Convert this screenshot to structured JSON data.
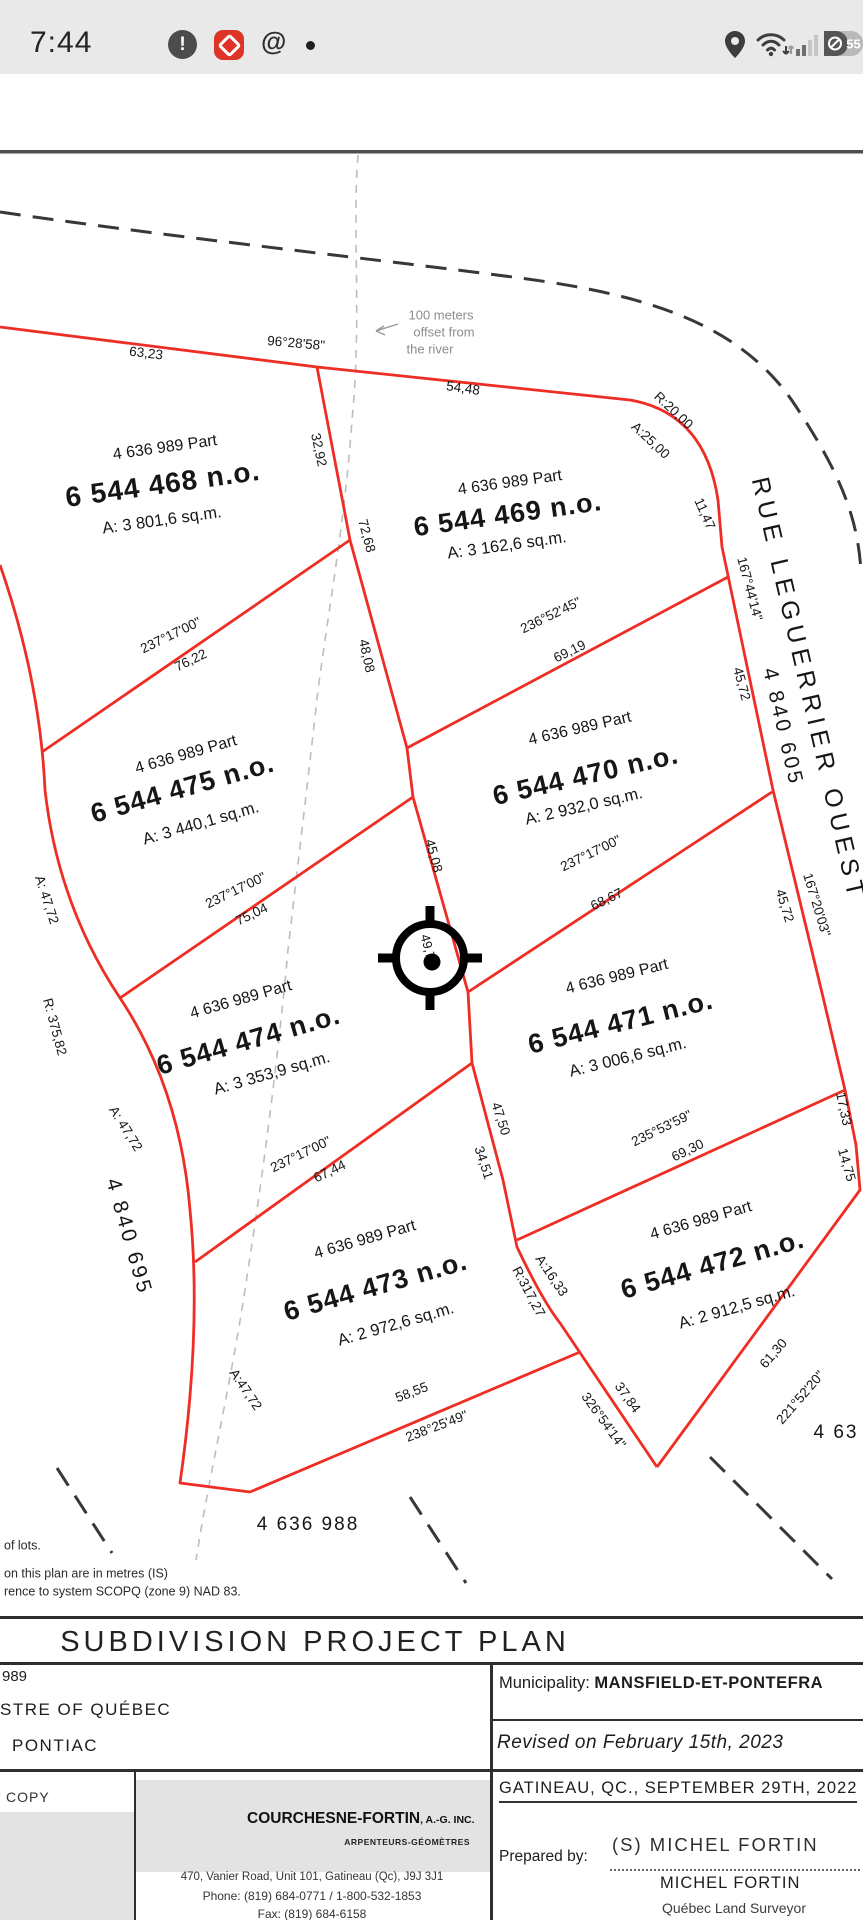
{
  "status_bar": {
    "time": "7:44",
    "battery_percent": "55",
    "icons": {
      "left": [
        "notification-exclamation-icon",
        "red-app-icon",
        "threads-icon",
        "recording-dot"
      ],
      "right": [
        "location-icon",
        "wifi-icon",
        "cell-signal-icon",
        "battery-icon"
      ]
    }
  },
  "plan": {
    "colors": {
      "lot_line": "#ee2e24",
      "boundary_dash": "#383838",
      "river_dash": "#bdbdbd",
      "text": "#161616",
      "muted": "#8d8d8d"
    },
    "labels": [
      {
        "t": "63,23",
        "x": 146,
        "y": 354,
        "r": 7,
        "s": 13.5,
        "n": "dim-label"
      },
      {
        "t": "96°28'58\"",
        "x": 296,
        "y": 344,
        "r": 5,
        "s": 13.5,
        "n": "dim-label"
      },
      {
        "t": "54,48",
        "x": 463,
        "y": 389,
        "r": 8,
        "s": 13.5,
        "n": "dim-label"
      },
      {
        "t": "R:20,00",
        "x": 673,
        "y": 411,
        "r": 43,
        "s": 13.5,
        "n": "dim-label"
      },
      {
        "t": "A:25,00",
        "x": 650,
        "y": 441,
        "r": 43,
        "s": 13.5,
        "n": "dim-label"
      },
      {
        "t": "11,47",
        "x": 704,
        "y": 514,
        "r": 66,
        "s": 13.5,
        "n": "dim-label"
      },
      {
        "t": "167°44'14\"",
        "x": 749,
        "y": 589,
        "r": 75,
        "s": 13.5,
        "n": "dim-label"
      },
      {
        "t": "45,72",
        "x": 741,
        "y": 684,
        "r": 75,
        "s": 13.5,
        "n": "dim-label"
      },
      {
        "t": "32,92",
        "x": 318,
        "y": 450,
        "r": 78,
        "s": 13.5,
        "n": "dim-label"
      },
      {
        "t": "72,68",
        "x": 366,
        "y": 536,
        "r": 75,
        "s": 13.5,
        "n": "dim-label"
      },
      {
        "t": "48,08",
        "x": 366,
        "y": 656,
        "r": 78,
        "s": 13.5,
        "n": "dim-label"
      },
      {
        "t": "45,08",
        "x": 433,
        "y": 856,
        "r": 75,
        "s": 13.5,
        "n": "dim-label"
      },
      {
        "t": "49,7",
        "x": 427,
        "y": 947,
        "r": 75,
        "s": 13,
        "n": "dim-label"
      },
      {
        "t": "47,50",
        "x": 500,
        "y": 1119,
        "r": 72,
        "s": 13.5,
        "n": "dim-label"
      },
      {
        "t": "34,51",
        "x": 483,
        "y": 1163,
        "r": 72,
        "s": 13.5,
        "n": "dim-label"
      },
      {
        "t": "A:16,33",
        "x": 551,
        "y": 1276,
        "r": 56,
        "s": 13.5,
        "n": "dim-label"
      },
      {
        "t": "R:317,27",
        "x": 528,
        "y": 1292,
        "r": 62,
        "s": 13.5,
        "n": "dim-label"
      },
      {
        "t": "37,84",
        "x": 627,
        "y": 1398,
        "r": 54,
        "s": 13.5,
        "n": "dim-label"
      },
      {
        "t": "326°54'14\"",
        "x": 603,
        "y": 1421,
        "r": 54,
        "s": 13.5,
        "n": "dim-label"
      },
      {
        "t": "61,30",
        "x": 774,
        "y": 1354,
        "r": -49,
        "s": 13.5,
        "n": "dim-label"
      },
      {
        "t": "221°52'20\"",
        "x": 801,
        "y": 1398,
        "r": -49,
        "s": 13.5,
        "n": "dim-label"
      },
      {
        "t": "58,55",
        "x": 412,
        "y": 1393,
        "r": -21,
        "s": 13.5,
        "n": "dim-label"
      },
      {
        "t": "238°25'49\"",
        "x": 437,
        "y": 1427,
        "r": -21,
        "s": 13.5,
        "n": "dim-label"
      },
      {
        "t": "235°53'59\"",
        "x": 662,
        "y": 1129,
        "r": -26,
        "s": 13.5,
        "n": "dim-label"
      },
      {
        "t": "69,30",
        "x": 688,
        "y": 1151,
        "r": -26,
        "s": 13.5,
        "n": "dim-label"
      },
      {
        "t": "237°17'00\"",
        "x": 171,
        "y": 636,
        "r": -26,
        "s": 13.5,
        "n": "dim-label"
      },
      {
        "t": "76,22",
        "x": 191,
        "y": 661,
        "r": -26,
        "s": 13.5,
        "n": "dim-label"
      },
      {
        "t": "236°52'45\"",
        "x": 551,
        "y": 616,
        "r": -26,
        "s": 13.5,
        "n": "dim-label"
      },
      {
        "t": "69,19",
        "x": 570,
        "y": 652,
        "r": -26,
        "s": 13.5,
        "n": "dim-label"
      },
      {
        "t": "237°17'00\"",
        "x": 236,
        "y": 891,
        "r": -26,
        "s": 13.5,
        "n": "dim-label"
      },
      {
        "t": "75,04",
        "x": 252,
        "y": 915,
        "r": -26,
        "s": 13.5,
        "n": "dim-label"
      },
      {
        "t": "237°17'00\"",
        "x": 591,
        "y": 854,
        "r": -26,
        "s": 13.5,
        "n": "dim-label"
      },
      {
        "t": "68,67",
        "x": 607,
        "y": 900,
        "r": -26,
        "s": 13.5,
        "n": "dim-label"
      },
      {
        "t": "237°17'00\"",
        "x": 301,
        "y": 1155,
        "r": -26,
        "s": 13.5,
        "n": "dim-label"
      },
      {
        "t": "67,44",
        "x": 330,
        "y": 1172,
        "r": -26,
        "s": 13.5,
        "n": "dim-label"
      },
      {
        "t": "A: 47,72",
        "x": 46,
        "y": 900,
        "r": 72,
        "s": 13.5,
        "n": "dim-label"
      },
      {
        "t": "R: 375,82",
        "x": 54,
        "y": 1027,
        "r": 75,
        "s": 13.5,
        "n": "dim-label"
      },
      {
        "t": "A: 47,72",
        "x": 125,
        "y": 1129,
        "r": 58,
        "s": 13.5,
        "n": "dim-label"
      },
      {
        "t": "A:47,72",
        "x": 245,
        "y": 1390,
        "r": 56,
        "s": 13.5,
        "n": "dim-label"
      },
      {
        "t": "17,33",
        "x": 843,
        "y": 1109,
        "r": 78,
        "s": 13.5,
        "n": "dim-label"
      },
      {
        "t": "14,75",
        "x": 846,
        "y": 1165,
        "r": 74,
        "s": 13.5,
        "n": "dim-label"
      },
      {
        "t": "167°20'03\"",
        "x": 816,
        "y": 905,
        "r": 73,
        "s": 13.5,
        "n": "dim-label"
      },
      {
        "t": "45,72",
        "x": 784,
        "y": 906,
        "r": 73,
        "s": 13.5,
        "n": "dim-label"
      },
      {
        "t": "4 636 989 Part",
        "x": 165,
        "y": 448,
        "r": -8,
        "s": 16,
        "n": "lot-part"
      },
      {
        "t": "6 544 468 n.o.",
        "x": 163,
        "y": 486,
        "r": -8,
        "s": 28,
        "b": 1,
        "ls": 1,
        "n": "lot-number"
      },
      {
        "t": "A: 3 801,6 sq.m.",
        "x": 162,
        "y": 521,
        "r": -8,
        "s": 16.5,
        "n": "lot-area"
      },
      {
        "t": "4 636 989 Part",
        "x": 510,
        "y": 483,
        "r": -8,
        "s": 16,
        "n": "lot-part"
      },
      {
        "t": "6 544 469 n.o.",
        "x": 508,
        "y": 516,
        "r": -8,
        "s": 27,
        "b": 1,
        "ls": 1,
        "n": "lot-number"
      },
      {
        "t": "A: 3 162,6 sq.m.",
        "x": 507,
        "y": 546,
        "r": -8,
        "s": 16.5,
        "n": "lot-area"
      },
      {
        "t": "4 636 989 Part",
        "x": 186,
        "y": 755,
        "r": -16,
        "s": 16,
        "n": "lot-part"
      },
      {
        "t": "6 544 475 n.o.",
        "x": 183,
        "y": 790,
        "r": -16,
        "s": 27,
        "b": 1,
        "ls": 1,
        "n": "lot-number"
      },
      {
        "t": "A: 3 440,1 sq.m.",
        "x": 201,
        "y": 824,
        "r": -16,
        "s": 16.5,
        "n": "lot-area"
      },
      {
        "t": "4 636 989 Part",
        "x": 580,
        "y": 729,
        "r": -13,
        "s": 16,
        "n": "lot-part"
      },
      {
        "t": "6 544 470 n.o.",
        "x": 586,
        "y": 777,
        "r": -13,
        "s": 27,
        "b": 1,
        "ls": 1,
        "n": "lot-number"
      },
      {
        "t": "A: 2 932,0 sq.m.",
        "x": 584,
        "y": 807,
        "r": -13,
        "s": 16.5,
        "n": "lot-area"
      },
      {
        "t": "4 636 989 Part",
        "x": 241,
        "y": 1000,
        "r": -16,
        "s": 16,
        "n": "lot-part"
      },
      {
        "t": "6 544 474 n.o.",
        "x": 249,
        "y": 1042,
        "r": -16,
        "s": 27,
        "b": 1,
        "ls": 1,
        "n": "lot-number"
      },
      {
        "t": "A: 3 353,9 sq.m.",
        "x": 272,
        "y": 1074,
        "r": -16,
        "s": 16.5,
        "n": "lot-area"
      },
      {
        "t": "4 636 989 Part",
        "x": 617,
        "y": 977,
        "r": -14,
        "s": 16,
        "n": "lot-part"
      },
      {
        "t": "6 544 471 n.o.",
        "x": 621,
        "y": 1024,
        "r": -14,
        "s": 27,
        "b": 1,
        "ls": 1,
        "n": "lot-number"
      },
      {
        "t": "A: 3 006,6 sq.m.",
        "x": 628,
        "y": 1058,
        "r": -14,
        "s": 16.5,
        "n": "lot-area"
      },
      {
        "t": "4 636 989 Part",
        "x": 365,
        "y": 1240,
        "r": -16,
        "s": 16,
        "n": "lot-part"
      },
      {
        "t": "6 544 473 n.o.",
        "x": 376,
        "y": 1288,
        "r": -16,
        "s": 27,
        "b": 1,
        "ls": 1,
        "n": "lot-number"
      },
      {
        "t": "A: 2 972,6 sq.m.",
        "x": 396,
        "y": 1325,
        "r": -16,
        "s": 16.5,
        "n": "lot-area"
      },
      {
        "t": "4 636 989 Part",
        "x": 701,
        "y": 1221,
        "r": -16,
        "s": 16,
        "n": "lot-part"
      },
      {
        "t": "6 544 472 n.o.",
        "x": 713,
        "y": 1266,
        "r": -16,
        "s": 27,
        "b": 1,
        "ls": 1,
        "n": "lot-number"
      },
      {
        "t": "A: 2 912,5 sq.m.",
        "x": 737,
        "y": 1308,
        "r": -16,
        "s": 16.5,
        "n": "lot-area"
      },
      {
        "t": "RUE LEGUERRIER OUEST",
        "x": 807,
        "y": 690,
        "r": 77,
        "s": 25,
        "ls": 6,
        "n": "street-name"
      },
      {
        "t": "4 840 605",
        "x": 782,
        "y": 727,
        "r": 77,
        "s": 21,
        "ls": 3,
        "n": "cadastre-number"
      },
      {
        "t": "4 840 695",
        "x": 128,
        "y": 1237,
        "r": 74,
        "s": 21,
        "ls": 3,
        "n": "cadastre-number"
      },
      {
        "t": "4 636 988",
        "x": 308,
        "y": 1525,
        "r": 0,
        "s": 19,
        "ls": 2,
        "n": "cadastre-number"
      },
      {
        "t": "4 63",
        "x": 836,
        "y": 1433,
        "r": 0,
        "s": 19,
        "ls": 2,
        "n": "cadastre-number"
      },
      {
        "t": "100 meters",
        "x": 441,
        "y": 316,
        "r": 0,
        "s": 13,
        "c": "#8d8d8d",
        "n": "river-note"
      },
      {
        "t": "offset from",
        "x": 444,
        "y": 333,
        "r": 0,
        "s": 13,
        "c": "#8d8d8d",
        "n": "river-note"
      },
      {
        "t": "the river",
        "x": 430,
        "y": 350,
        "r": 0,
        "s": 13,
        "c": "#8d8d8d",
        "n": "river-note"
      },
      {
        "t": "of lots.",
        "x": 4,
        "y": 1546,
        "r": 0,
        "s": 12.5,
        "a": "start",
        "c": "#2a2a2a",
        "n": "plan-note"
      },
      {
        "t": "on this plan are in metres (IS)",
        "x": 4,
        "y": 1574,
        "r": 0,
        "s": 12.5,
        "a": "start",
        "c": "#2a2a2a",
        "n": "plan-note"
      },
      {
        "t": "rence to system SCOPQ (zone 9) NAD 83.",
        "x": 4,
        "y": 1592,
        "r": 0,
        "s": 12.5,
        "a": "start",
        "c": "#2a2a2a",
        "n": "plan-note"
      }
    ]
  },
  "title_block": {
    "banner": "SUBDIVISION PROJECT PLAN",
    "left_lines": [
      "989",
      "STRE OF QUÉBEC",
      "PONTIAC"
    ],
    "municipality_label": "Municipality:",
    "municipality_value": "MANSFIELD-ET-PONTEFRA",
    "revised": "Revised on February 15th, 2023",
    "place_date": "GATINEAU, QC., SEPTEMBER 29TH, 2022",
    "prepared_by_label": "Prepared by:",
    "signature": "(S) MICHEL FORTIN",
    "surveyor_name": "MICHEL FORTIN",
    "surveyor_title": "Québec Land Surveyor",
    "copy": "COPY",
    "company": {
      "name": "COURCHESNE-FORTIN",
      "suffix": ", A.-G. INC.",
      "subtitle": "ARPENTEURS-GÉOMÈTRES",
      "address": "470, Vanier Road, Unit 101, Gatineau (Qc), J9J 3J1",
      "phone": "Phone: (819) 684-0771 / 1-800-532-1853",
      "fax": "Fax: (819) 684-6158"
    }
  }
}
